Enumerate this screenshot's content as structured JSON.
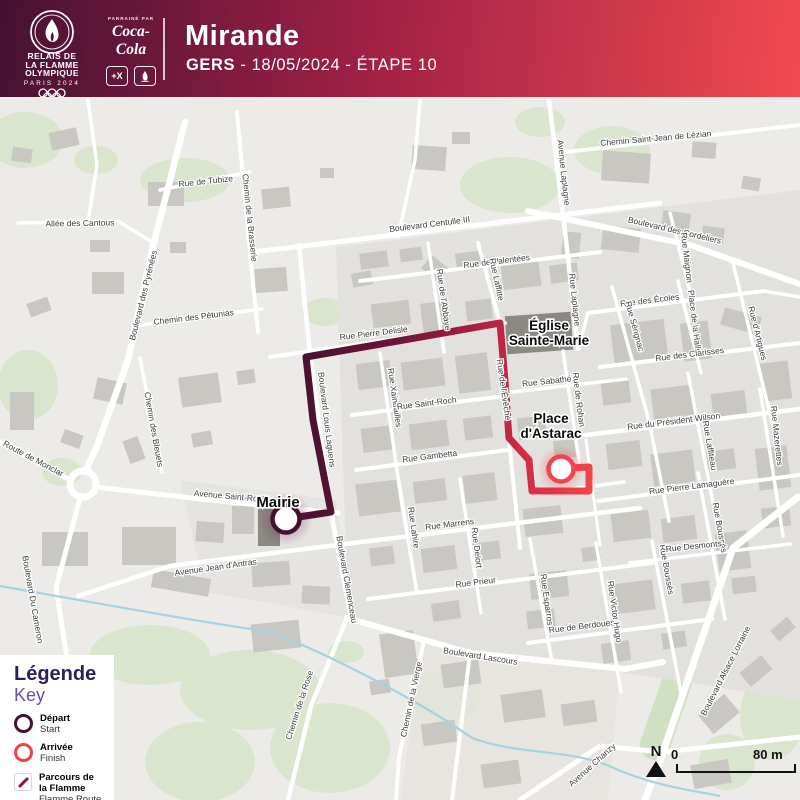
{
  "header": {
    "logo": {
      "title_lines": [
        "RELAIS DE",
        "LA FLAMME",
        "OLYMPIQUE"
      ],
      "subtitle": "PARIS 2024"
    },
    "sponsor": {
      "label": "PARRAINÉ PAR",
      "name": "Coca-Cola",
      "badge1": "+X",
      "badge2": "paris-2024-emblem"
    },
    "city": "Mirande",
    "department": "GERS",
    "subtitle_rest": " - 18/05/2024 - ÉTAPE 10"
  },
  "legend": {
    "title": "Légende",
    "key": "Key",
    "items": [
      {
        "label": "Départ",
        "sublabel": "Start",
        "icon": "start-circle"
      },
      {
        "label": "Arrivée",
        "sublabel": "Finish",
        "icon": "finish-circle"
      },
      {
        "label": "Parcours de la Flamme",
        "sublabel": "Flamme Route",
        "icon": "route-line"
      }
    ]
  },
  "map": {
    "compass_label": "N",
    "scale_zero": "0",
    "scale_label": "80 m",
    "route": {
      "points": [
        [
          286,
          519
        ],
        [
          331,
          512
        ],
        [
          313,
          420
        ],
        [
          306,
          357
        ],
        [
          398,
          341
        ],
        [
          500,
          323
        ],
        [
          505,
          381
        ],
        [
          509,
          438
        ],
        [
          529,
          460
        ],
        [
          532,
          491
        ],
        [
          589,
          491
        ],
        [
          589,
          467
        ],
        [
          569,
          468
        ]
      ],
      "start": {
        "x": 286,
        "y": 519
      },
      "finish": {
        "x": 561,
        "y": 469
      }
    },
    "poi_labels": [
      {
        "lines": [
          "Mairie"
        ],
        "x": 278,
        "y": 507,
        "s": 15
      },
      {
        "lines": [
          "Place",
          "d'Astarac"
        ],
        "x": 551,
        "y": 423,
        "s": 13.5
      },
      {
        "lines": [
          "Église",
          "Sainte-Marie"
        ],
        "x": 549,
        "y": 330,
        "s": 13.5
      }
    ],
    "street_labels": [
      {
        "t": "Chemin Saint-Jean de Lézian",
        "x": 656,
        "y": 141,
        "r": -5
      },
      {
        "t": "Rue de Tubize",
        "x": 206,
        "y": 184,
        "r": -6
      },
      {
        "t": "Chemin de la Brasserie",
        "x": 247,
        "y": 218,
        "r": 84
      },
      {
        "t": "Allée des Cantous",
        "x": 80,
        "y": 226,
        "r": -1
      },
      {
        "t": "Boulevard des Pyrénées",
        "x": 146,
        "y": 296,
        "r": -76
      },
      {
        "t": "Chemin des Pétunias",
        "x": 194,
        "y": 320,
        "r": -7
      },
      {
        "t": "Chemin des Bleuets",
        "x": 151,
        "y": 430,
        "r": 80
      },
      {
        "t": "Route de Monclar",
        "x": 32,
        "y": 461,
        "r": 28
      },
      {
        "t": "Boulevard Du Cameron",
        "x": 30,
        "y": 600,
        "r": 80
      },
      {
        "t": "Boulevard Centulle III",
        "x": 430,
        "y": 227,
        "r": -7
      },
      {
        "t": "Rue de Valentées",
        "x": 497,
        "y": 264,
        "r": -7
      },
      {
        "t": "Avenue Laplagne",
        "x": 561,
        "y": 173,
        "r": 84
      },
      {
        "t": "Rue Laplagne",
        "x": 572,
        "y": 300,
        "r": 84
      },
      {
        "t": "Boulevard des Cordeliers",
        "x": 674,
        "y": 233,
        "r": 13
      },
      {
        "t": "Rue Maignon",
        "x": 684,
        "y": 258,
        "r": 83
      },
      {
        "t": "Rue des Écoles",
        "x": 650,
        "y": 303,
        "r": -7
      },
      {
        "t": "Rue Sérignac",
        "x": 632,
        "y": 327,
        "r": 75
      },
      {
        "t": "Place de la Halle",
        "x": 692,
        "y": 322,
        "r": 83
      },
      {
        "t": "Rue d'Artigues",
        "x": 755,
        "y": 334,
        "r": 76
      },
      {
        "t": "Rue des Clarisses",
        "x": 690,
        "y": 357,
        "r": -7
      },
      {
        "t": "Rue Mazerettes",
        "x": 774,
        "y": 436,
        "r": 84
      },
      {
        "t": "Rue du Président Wilson",
        "x": 674,
        "y": 424,
        "r": -7
      },
      {
        "t": "Rue Laffiteau",
        "x": 707,
        "y": 446,
        "r": 80
      },
      {
        "t": "Rue Pierre Lamaguère",
        "x": 692,
        "y": 489,
        "r": -7
      },
      {
        "t": "Rue Boussés",
        "x": 717,
        "y": 528,
        "r": 80
      },
      {
        "t": "Rue Boussés",
        "x": 664,
        "y": 570,
        "r": 80
      },
      {
        "t": "Rue Desmonts",
        "x": 694,
        "y": 549,
        "r": -6
      },
      {
        "t": "Rue Pierre Delisle",
        "x": 374,
        "y": 336,
        "r": -7
      },
      {
        "t": "Rue de l'Abbaye",
        "x": 441,
        "y": 300,
        "r": 82
      },
      {
        "t": "Rue Laffitte",
        "x": 494,
        "y": 280,
        "r": 78
      },
      {
        "t": "Rue Xaintrailles",
        "x": 392,
        "y": 398,
        "r": 82
      },
      {
        "t": "Rue Saint-Roch",
        "x": 427,
        "y": 406,
        "r": -7
      },
      {
        "t": "Rue Gambetta",
        "x": 430,
        "y": 459,
        "r": -7
      },
      {
        "t": "Boulevard Louis Laguens",
        "x": 324,
        "y": 420,
        "r": 83
      },
      {
        "t": "Rue de l'Évêché",
        "x": 501,
        "y": 390,
        "r": 82
      },
      {
        "t": "Rue Sabathé",
        "x": 547,
        "y": 384,
        "r": -6
      },
      {
        "t": "Rue de Rohan",
        "x": 576,
        "y": 400,
        "r": 83
      },
      {
        "t": "Avenue Saint-Roch",
        "x": 230,
        "y": 499,
        "r": 5
      },
      {
        "t": "Avenue Jean d'Antras",
        "x": 216,
        "y": 570,
        "r": -8
      },
      {
        "t": "Boulevard Clemenceau",
        "x": 344,
        "y": 580,
        "r": 80
      },
      {
        "t": "Rue Lahire",
        "x": 411,
        "y": 528,
        "r": 82
      },
      {
        "t": "Rue Marrens",
        "x": 450,
        "y": 527,
        "r": -7
      },
      {
        "t": "Rue Delort",
        "x": 474,
        "y": 548,
        "r": 83
      },
      {
        "t": "Rue Prieur",
        "x": 476,
        "y": 585,
        "r": -7
      },
      {
        "t": "Rue Esparros",
        "x": 544,
        "y": 600,
        "r": 82
      },
      {
        "t": "Rue de Berdoues",
        "x": 582,
        "y": 629,
        "r": -7
      },
      {
        "t": "Rue Victor Hugo",
        "x": 612,
        "y": 612,
        "r": 82
      },
      {
        "t": "Boulevard Lascours",
        "x": 480,
        "y": 659,
        "r": 9
      },
      {
        "t": "Chemin de la Rose",
        "x": 302,
        "y": 706,
        "r": -72
      },
      {
        "t": "Chemin de la Vierge",
        "x": 414,
        "y": 700,
        "r": -78
      },
      {
        "t": "Avenue Chanzy",
        "x": 594,
        "y": 767,
        "r": -42
      },
      {
        "t": "Boulevard Alsace Lorraine",
        "x": 728,
        "y": 672,
        "r": -63
      }
    ]
  },
  "colors": {
    "header_gradient_start": "#451232",
    "header_gradient_mid": "#a02045",
    "header_gradient_end": "#f04a50",
    "route_start": "#451030",
    "route_mid": "#a41d41",
    "route_end": "#f0454d",
    "legend_title": "#2c1f60",
    "legend_key": "#6252a8",
    "depart_ring": "#451232",
    "arrivee_ring": "#ee4249",
    "map_bg": "#edebe7",
    "road": "#ffffff",
    "building": "#c9c7c1",
    "green": "#d9e6cd",
    "water": "#a5d2e0"
  }
}
